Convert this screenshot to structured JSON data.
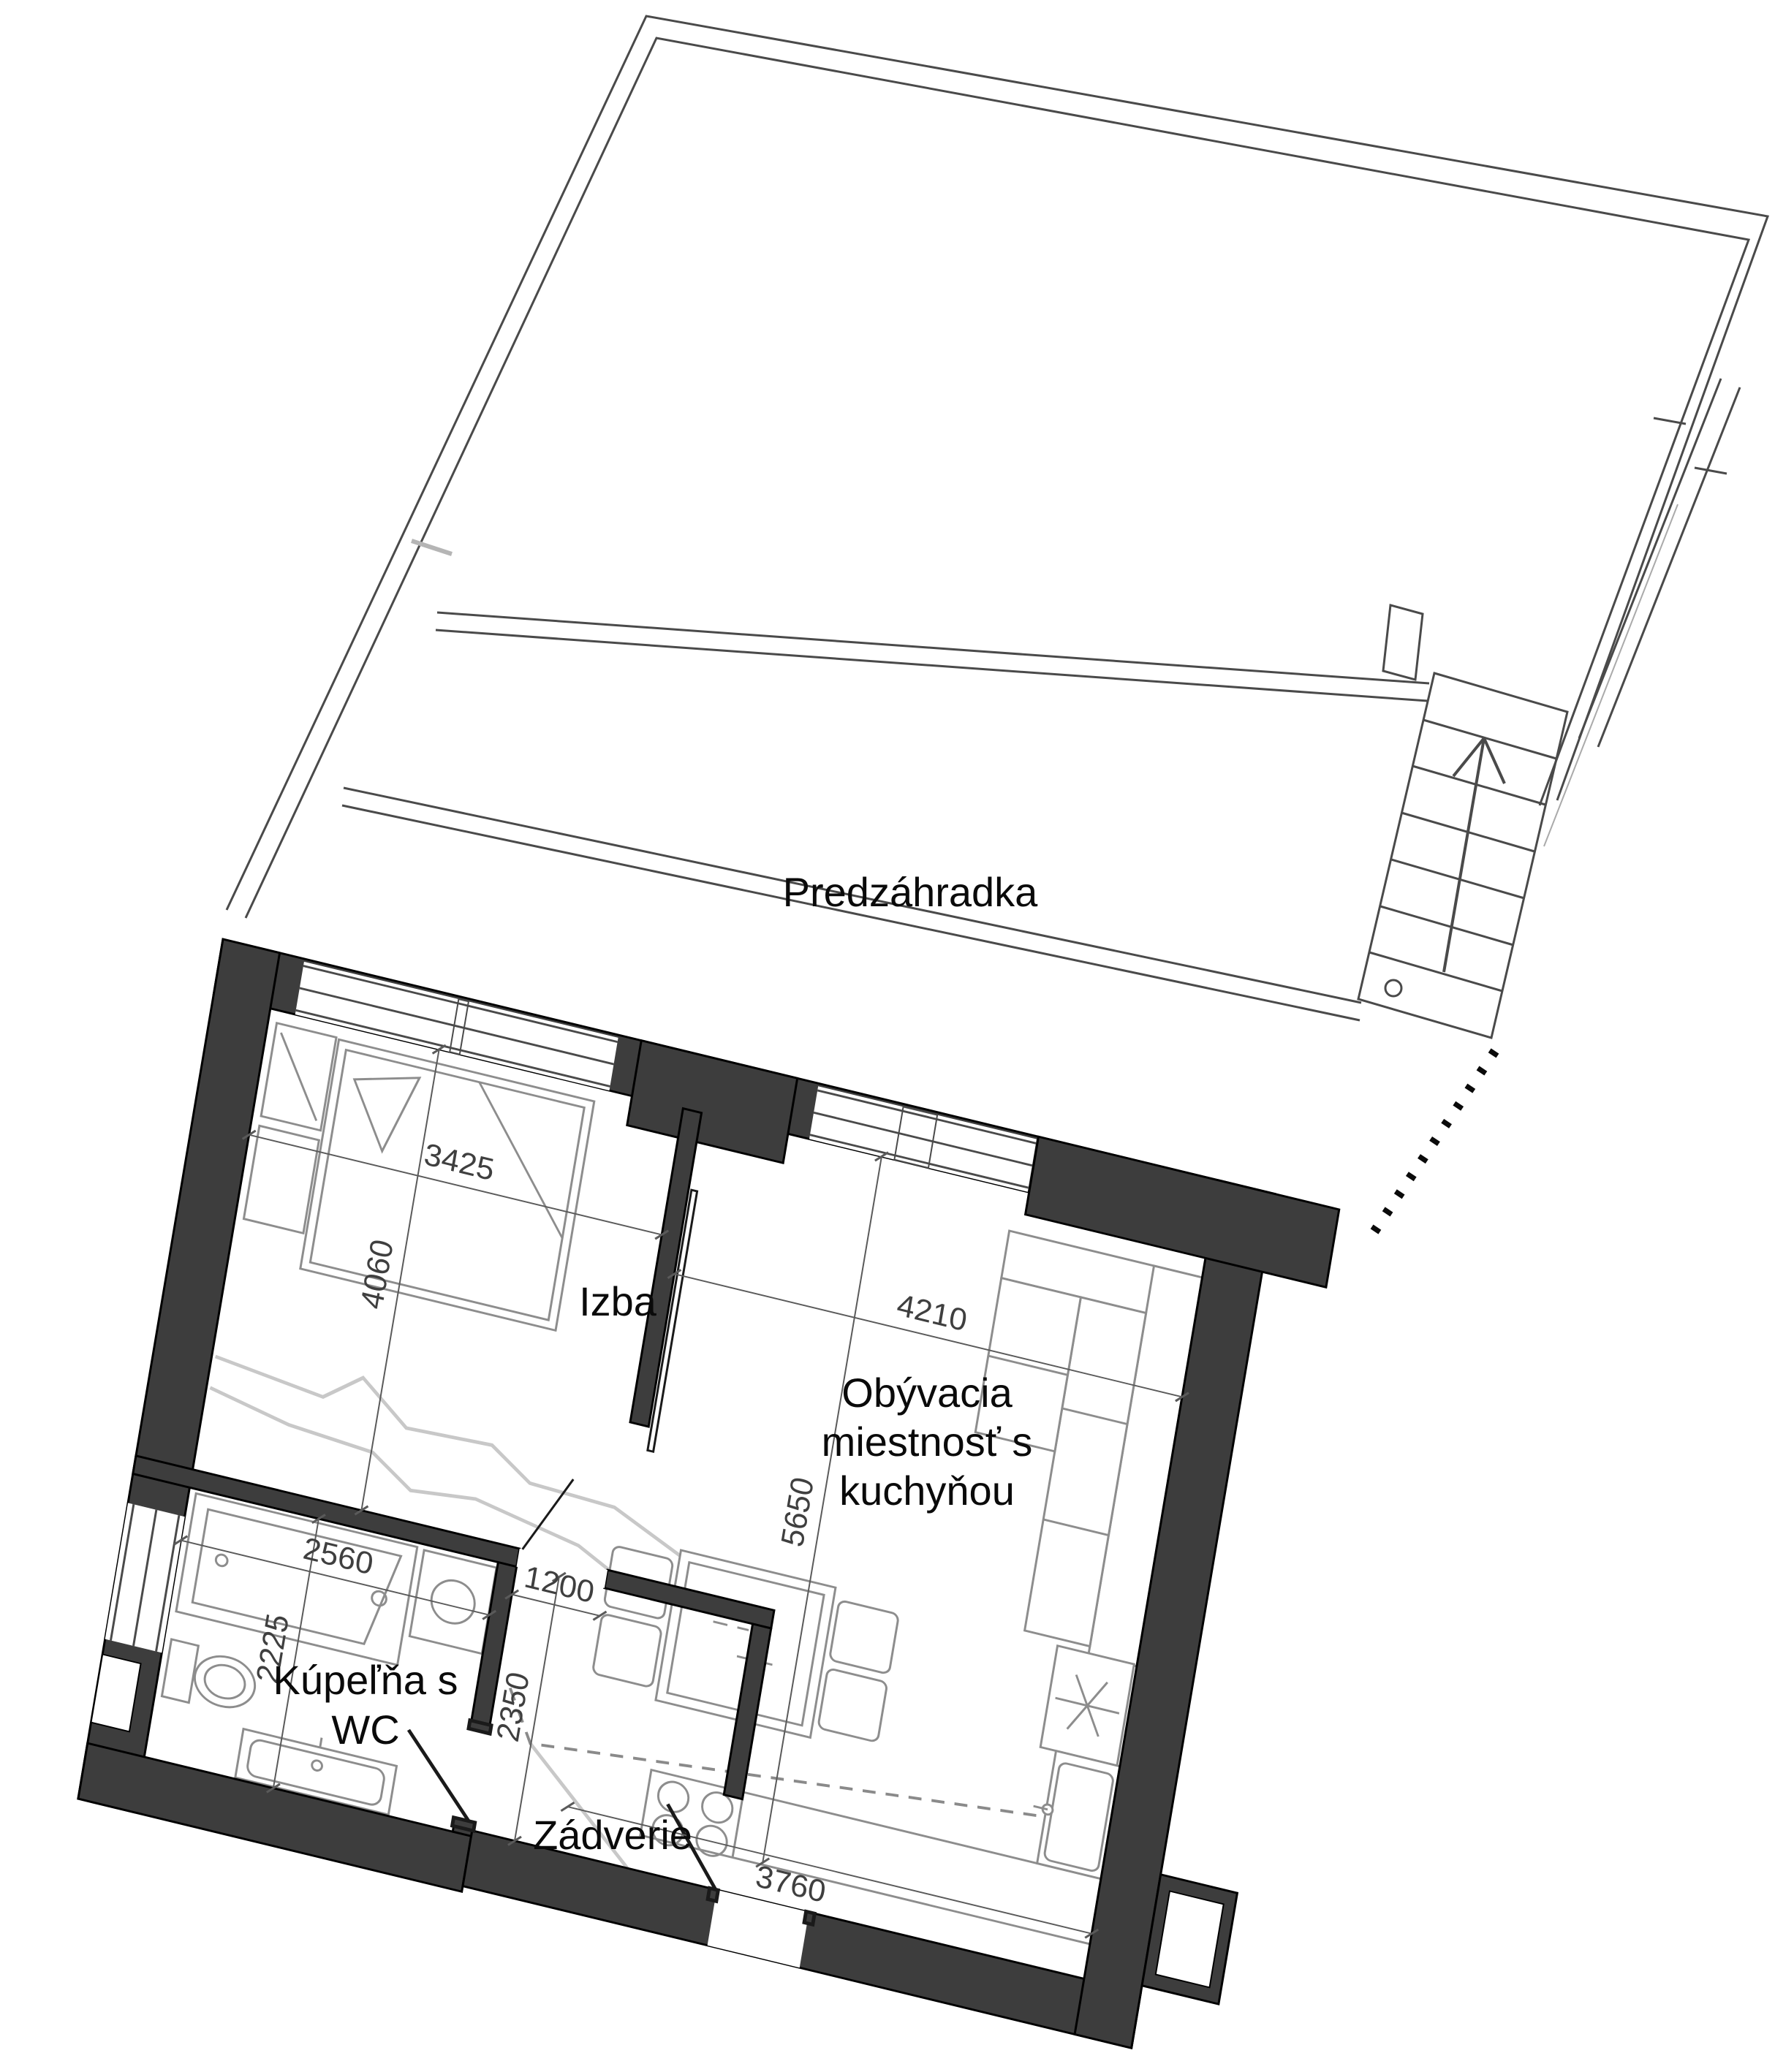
{
  "plan": {
    "garden": {
      "label": "Predzáhradka"
    },
    "rooms": {
      "izba": {
        "label": "Izba",
        "width_mm": "3425",
        "depth_mm": "4060"
      },
      "living": {
        "label_line1": "Obývacia",
        "label_line2": "miestnosť s",
        "label_line3": "kuchyňou",
        "width_mm": "4210",
        "depth_mm": "5650"
      },
      "bathroom": {
        "label_line1": "Kúpeľňa s",
        "label_line2": "WC",
        "width_mm": "2560",
        "depth_mm": "2225"
      },
      "hall": {
        "label": "Zádverie",
        "opening_mm": "1200",
        "depth_mm": "2350"
      },
      "kitchen_run_mm": "3760"
    },
    "colors": {
      "wall": "#3d3d3d",
      "outline": "#000000",
      "thin_line": "#4a4a4a",
      "dim": "#3f3f3f",
      "decor_gray": "#c8c8c8"
    }
  }
}
